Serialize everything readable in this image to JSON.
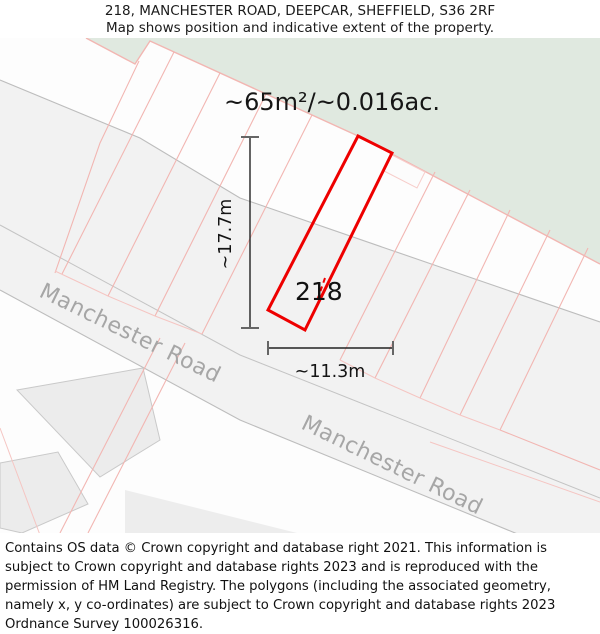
{
  "header": {
    "title": "218, MANCHESTER ROAD, DEEPCAR, SHEFFIELD, S36 2RF",
    "subtitle": "Map shows position and indicative extent of the property."
  },
  "map": {
    "area_label": "~65m²/~0.016ac.",
    "property_number": "218",
    "dimensions": {
      "height_label": "~17.7m",
      "width_label": "~11.3m"
    },
    "road_labels": [
      "Manchester Road",
      "Manchester Road"
    ],
    "colors": {
      "highlight_red": "#ee0000",
      "parcel_line_pink": "#f2b6b2",
      "green_area": "#e0e9e0",
      "road_fill": "#f2f2f2",
      "road_casing_gray": "#bdbdbd",
      "building_fill": "#ececec",
      "road_label_gray": "#a6a6a6",
      "background": "#fdfdfd"
    }
  },
  "footer": {
    "attribution": "Contains OS data © Crown copyright and database right 2021. This information is subject to Crown copyright and database rights 2023 and is reproduced with the permission of HM Land Registry. The polygons (including the associated geometry, namely x, y co-ordinates) are subject to Crown copyright and database rights 2023 Ordnance Survey 100026316."
  }
}
